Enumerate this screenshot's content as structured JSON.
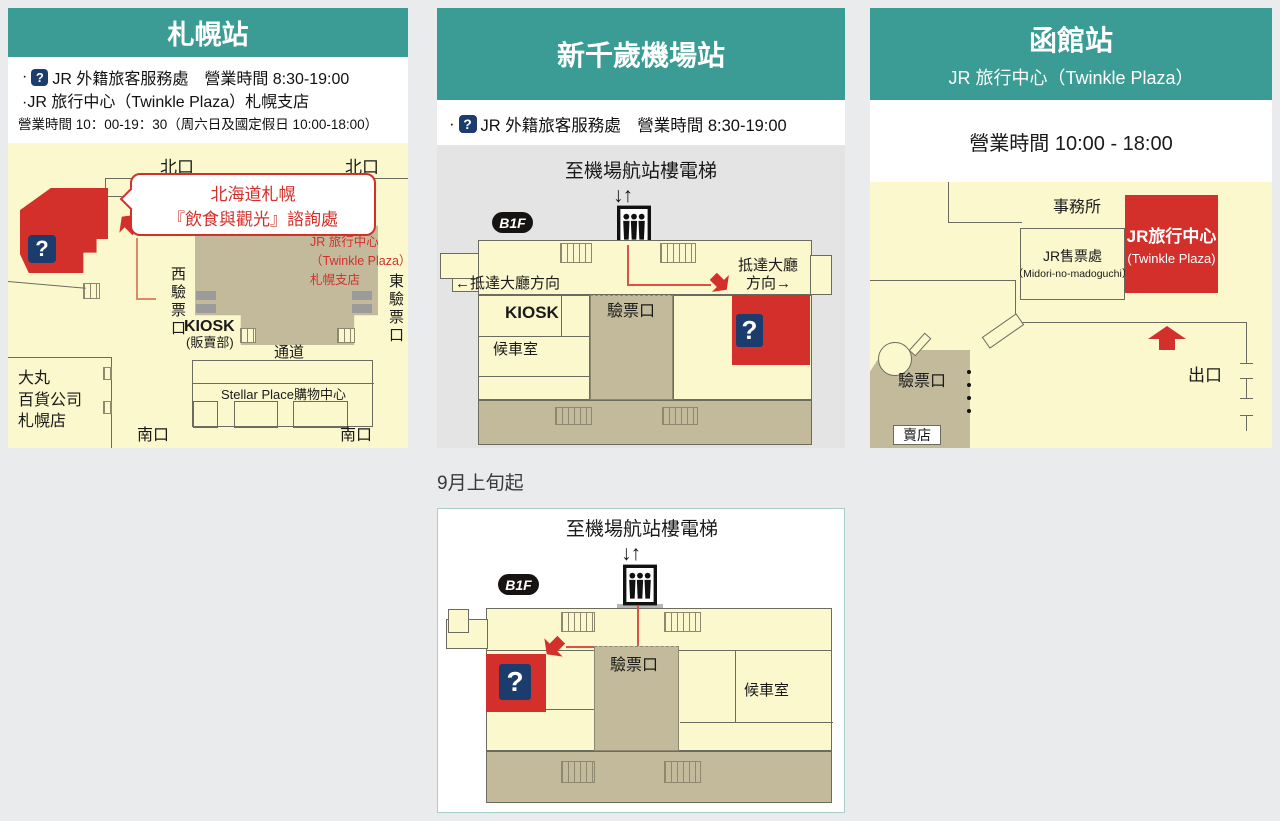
{
  "colors": {
    "teal_header": "#3a9c94",
    "cream_floor": "#fbf8cd",
    "tan_concourse": "#c3ba9b",
    "accent_red": "#d3302b",
    "question_navy": "#1c3c6e",
    "page_bg": "#e9ebec",
    "chitose_map_bg": "#e4e4e5"
  },
  "icons": {
    "question": "?",
    "up_down": "↓↑",
    "floor_badge": "B1F"
  },
  "sapporo": {
    "title": "札幌站",
    "bullet": "·",
    "info1": "JR 外籍旅客服務處　營業時間 8:30-19:00",
    "info2": "·JR 旅行中心（Twinkle Plaza）札幌支店",
    "info3": "營業時間 10：00-19：30（周六日及國定假日 10:00-18:00）",
    "north_left": "北口",
    "north_right": "北口",
    "passage_top": "通道",
    "passage_bottom": "通道",
    "callout1": "北海道札幌",
    "callout2": "『飲食與觀光』諮詢處",
    "jr1": "JR 旅行中心",
    "jr2": "（Twinkle Plaza）",
    "jr3": "札幌支店",
    "west_gate": "西驗票口",
    "east_gate": "東驗票口",
    "kiosk": "KIOSK",
    "kiosk_sub": "(販賣部)",
    "stellar": "Stellar Place購物中心",
    "daimaru1": "大丸",
    "daimaru2": "百貨公司",
    "daimaru3": "札幌店",
    "south_left": "南口",
    "south_right": "南口"
  },
  "chitose": {
    "title": "新千歲機場站",
    "bullet": "·",
    "info1": "JR 外籍旅客服務處　營業時間 8:30-19:00",
    "elevator": "至機場航站樓電梯",
    "arrival_left": "←抵達大廳方向",
    "arrival_right1": "抵達大廳",
    "arrival_right2": "方向→",
    "kiosk": "KIOSK",
    "waiting": "候車室",
    "gate": "驗票口"
  },
  "hakodate": {
    "title": "函館站",
    "subtitle": "JR 旅行中心（Twinkle Plaza）",
    "hours": "營業時間 10:00 - 18:00",
    "office": "事務所",
    "ticket1": "JR售票處",
    "ticket2": "（Midori-no-madoguchi）",
    "jr1": "JR旅行中心",
    "jr2": "(Twinkle Plaza)",
    "gate": "驗票口",
    "shop": "賣店",
    "exit": "出口"
  },
  "september": {
    "label": "9月上旬起",
    "elevator": "至機場航站樓電梯",
    "gate": "驗票口",
    "waiting": "候車室"
  }
}
